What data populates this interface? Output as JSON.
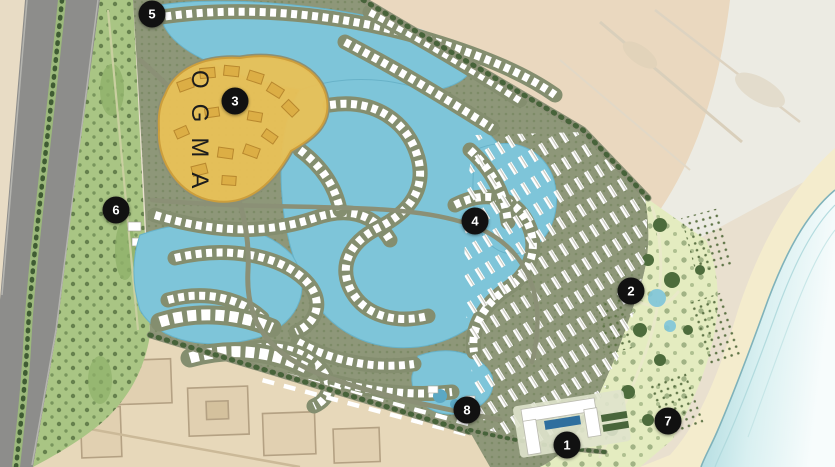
{
  "zone": {
    "label": "OGMA"
  },
  "markers": [
    {
      "label": "1",
      "x": 567,
      "y": 445
    },
    {
      "label": "2",
      "x": 631,
      "y": 291
    },
    {
      "label": "3",
      "x": 235,
      "y": 101
    },
    {
      "label": "4",
      "x": 475,
      "y": 221
    },
    {
      "label": "5",
      "x": 152,
      "y": 14
    },
    {
      "label": "6",
      "x": 116,
      "y": 210
    },
    {
      "label": "7",
      "x": 668,
      "y": 421
    },
    {
      "label": "8",
      "x": 467,
      "y": 410
    }
  ],
  "colors": {
    "lagoon": "#7ec5d9",
    "sea_shore": "#9ed2d8",
    "sea_far": "#f7fcfc",
    "development_green": "#8e9779",
    "coastal_park": "#e4ecc0",
    "buffer_green": "#a9c584",
    "zone_yellow": "#e8c158",
    "zone_border": "#cf9f3a",
    "highway_gray": "#8d8d8b",
    "desert_tan": "#e9e0cf",
    "beach_sand": "#f4eccd",
    "marker_bg": "#111111",
    "marker_text": "#ffffff"
  }
}
